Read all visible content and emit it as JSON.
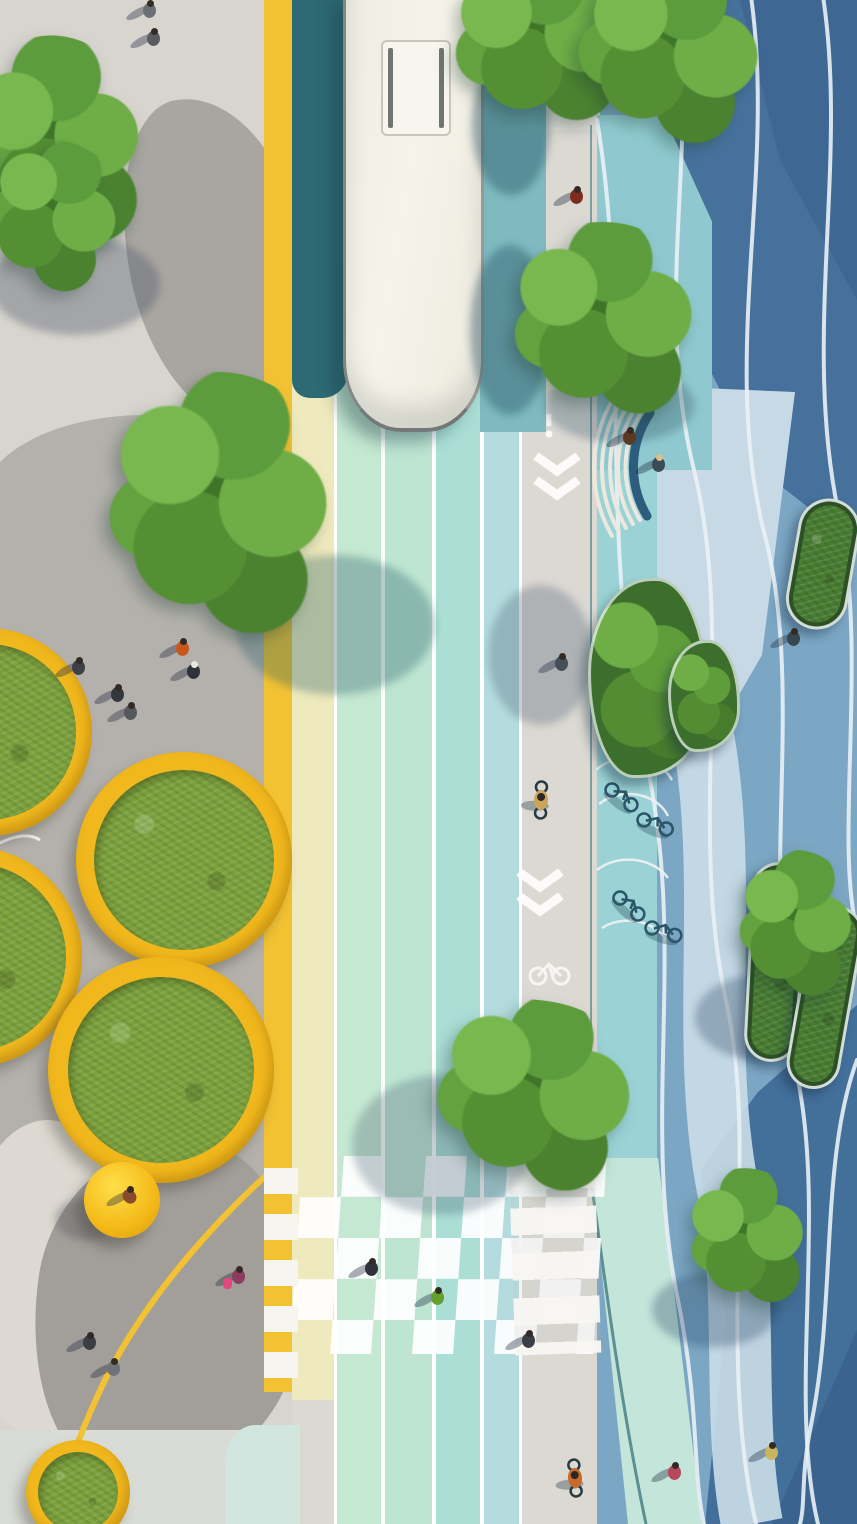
{
  "meta": {
    "kind": "architectural aerial rendering",
    "view": "top-down street redesign visualization",
    "visible_text": "none"
  },
  "palette": {
    "plaza_gray_light": "#d8d5ce",
    "plaza_gray_mid": "#b4b1ac",
    "plaza_gray_dark": "#a29f9a",
    "curb_yellow": "#f2c233",
    "buffer_pale_yellow": "#efeabd",
    "lane_mint_1": "#c5e8d2",
    "lane_mint_2": "#bde5d2",
    "lane_aqua": "#abdfd6",
    "lane_blue": "#b4dcde",
    "lane_shadow_teal": "#2e6a74",
    "lane_sunlit_teal": "#7fbac0",
    "path_gray": "#dcd9d3",
    "marking_white": "#fdfdfb",
    "bikezone_aqua": "#9ad2d6",
    "plaza_blue_base": "#7ba6c4",
    "plaza_blue_dark": "#46719c",
    "plaza_blue_pale": "#c6d9e5",
    "planter_rim_yellow": "#f1b81d",
    "grass_green": "#7ba23c",
    "tree_green": "#5d9c3c",
    "bus_body": "#f3f0e8",
    "bench_back_blue": "#2d5c7c"
  },
  "zones": [
    {
      "name": "pedestrian-plaza-left",
      "surface": "gray concrete with organic paving patches"
    },
    {
      "name": "yellow-curb-stripe",
      "surface": "painted yellow edge line"
    },
    {
      "name": "pale-yellow-buffer",
      "surface": "painted buffer band"
    },
    {
      "name": "transit-lanes",
      "surface": "four mint/aqua colored lanes with white separators"
    },
    {
      "name": "shared-path-gray",
      "surface": "light gray cycle/pedestrian path with chevrons and bike symbol"
    },
    {
      "name": "bike-parking-aqua-strip",
      "surface": "aqua zone with looped bike racks"
    },
    {
      "name": "blue-plaza-right",
      "surface": "blue surface with white flowing wave lines, sun and shadow patches"
    },
    {
      "name": "checkerboard-crossing",
      "surface": "white checker squares over colored lanes"
    },
    {
      "name": "zebra-crossing",
      "surface": "white bars over gray path"
    },
    {
      "name": "yellow-bar-crossing",
      "surface": "white bars over yellow curb band"
    }
  ],
  "scene": {
    "bus": {
      "x": 343,
      "y": -8,
      "w": 141,
      "h": 440,
      "hatch": {
        "x": 378,
        "y": 40,
        "w": 70,
        "h": 96
      }
    },
    "trees": [
      {
        "x": -35,
        "y": 35,
        "w": 185,
        "h": 235,
        "rot": -8
      },
      {
        "x": -25,
        "y": 140,
        "w": 150,
        "h": 160,
        "rot": 14
      },
      {
        "x": 92,
        "y": 372,
        "w": 250,
        "h": 285,
        "rot": 3
      },
      {
        "x": 438,
        "y": -45,
        "w": 205,
        "h": 180,
        "rot": -5
      },
      {
        "x": 560,
        "y": -35,
        "w": 215,
        "h": 185,
        "rot": 9
      },
      {
        "x": 498,
        "y": 222,
        "w": 210,
        "h": 210,
        "rot": -3
      },
      {
        "x": 418,
        "y": 1000,
        "w": 230,
        "h": 200,
        "rot": 6
      },
      {
        "x": 682,
        "y": 1168,
        "w": 130,
        "h": 150,
        "rot": -6
      },
      {
        "x": 732,
        "y": 850,
        "w": 125,
        "h": 160,
        "rot": 4
      }
    ],
    "tree_shadows": [
      {
        "x": -10,
        "y": 235,
        "w": 170,
        "h": 100,
        "c": "rgba(80,88,105,0.38)"
      },
      {
        "x": 235,
        "y": 555,
        "w": 200,
        "h": 140,
        "c": "rgba(35,90,100,0.32)"
      },
      {
        "x": 472,
        "y": 55,
        "w": 78,
        "h": 140,
        "c": "rgba(35,80,95,0.42)"
      },
      {
        "x": 470,
        "y": 245,
        "w": 80,
        "h": 170,
        "c": "rgba(35,80,95,0.40)"
      },
      {
        "x": 488,
        "y": 585,
        "w": 105,
        "h": 140,
        "c": "rgba(70,90,108,0.30)"
      },
      {
        "x": 352,
        "y": 1075,
        "w": 180,
        "h": 140,
        "c": "rgba(70,92,112,0.30)"
      },
      {
        "x": 545,
        "y": 368,
        "w": 150,
        "h": 75,
        "c": "rgba(45,80,100,0.30)"
      },
      {
        "x": 652,
        "y": 1272,
        "w": 125,
        "h": 75,
        "c": "rgba(30,60,92,0.30)"
      },
      {
        "x": 695,
        "y": 975,
        "w": 130,
        "h": 85,
        "c": "rgba(28,58,90,0.30)"
      },
      {
        "x": 55,
        "y": 1198,
        "w": 60,
        "h": 42,
        "c": "rgba(95,95,100,0.40)"
      }
    ],
    "planters_circular": [
      {
        "cx": -12,
        "cy": 732,
        "r": 104,
        "rim": 16
      },
      {
        "cx": 184,
        "cy": 860,
        "r": 108,
        "rim": 18
      },
      {
        "cx": -28,
        "cy": 957,
        "r": 110,
        "rim": 16
      },
      {
        "cx": 161,
        "cy": 1070,
        "r": 113,
        "rim": 20
      },
      {
        "cx": 78,
        "cy": 1492,
        "r": 52,
        "rim": 12
      }
    ],
    "planters_pill": [
      {
        "x": 792,
        "y": 498,
        "w": 62,
        "h": 132,
        "rot": 10
      },
      {
        "x": 748,
        "y": 862,
        "w": 54,
        "h": 200,
        "rot": 3
      },
      {
        "x": 798,
        "y": 905,
        "w": 54,
        "h": 185,
        "rot": 10
      }
    ],
    "shrub_planters": [
      {
        "x": 588,
        "y": 578,
        "w": 120,
        "h": 200
      },
      {
        "x": 668,
        "y": 640,
        "w": 72,
        "h": 112
      }
    ],
    "dome_seat": {
      "cx": 122,
      "cy": 1200,
      "r": 38
    },
    "people": [
      {
        "x": 148,
        "y": 10,
        "c": "#6b6f73"
      },
      {
        "x": 152,
        "y": 38,
        "c": "#585c60"
      },
      {
        "x": 575,
        "y": 196,
        "c": "#7c2d1d"
      },
      {
        "x": 181,
        "y": 648,
        "c": "#c7571f"
      },
      {
        "x": 192,
        "y": 671,
        "c": "#2f3238",
        "hat": "#e8e6e0"
      },
      {
        "x": 77,
        "y": 667,
        "c": "#3c3f44"
      },
      {
        "x": 116,
        "y": 694,
        "c": "#34373c"
      },
      {
        "x": 129,
        "y": 712,
        "c": "#56585c"
      },
      {
        "x": 628,
        "y": 437,
        "c": "#5b3a24"
      },
      {
        "x": 657,
        "y": 464,
        "c": "#3b4b55",
        "hat": "#d9c08a"
      },
      {
        "x": 792,
        "y": 638,
        "c": "#37474f"
      },
      {
        "x": 560,
        "y": 663,
        "c": "#444f58"
      },
      {
        "x": 370,
        "y": 1268,
        "c": "#2f343a"
      },
      {
        "x": 436,
        "y": 1297,
        "c": "#63a02e"
      },
      {
        "x": 527,
        "y": 1340,
        "c": "#3a3e45"
      },
      {
        "x": 128,
        "y": 1196,
        "c": "#8a4a2c",
        "rot": -40
      },
      {
        "x": 237,
        "y": 1276,
        "c": "#8c3b5e",
        "bag": "#e2477f"
      },
      {
        "x": 88,
        "y": 1342,
        "c": "#3b3e42"
      },
      {
        "x": 112,
        "y": 1368,
        "c": "#70747a"
      },
      {
        "x": 673,
        "y": 1472,
        "c": "#b5485a"
      },
      {
        "x": 770,
        "y": 1452,
        "c": "#c9b45f"
      }
    ],
    "cyclists": [
      {
        "x": 541,
        "y": 800,
        "c": "#caa45a",
        "rot": 182
      },
      {
        "x": 575,
        "y": 1478,
        "c": "#c96a2d",
        "rot": 175
      }
    ],
    "parked_bikes": [
      {
        "x": 612,
        "y": 790,
        "rot": 38
      },
      {
        "x": 644,
        "y": 820,
        "rot": 22
      },
      {
        "x": 620,
        "y": 898,
        "rot": 42
      },
      {
        "x": 652,
        "y": 928,
        "rot": 18
      }
    ],
    "rack_arcs": [
      "M596,770 A46,38 0 0 1 672,780",
      "M599,804 A42,34 0 0 1 668,816",
      "M597,870 A46,38 0 0 1 668,878",
      "M602,928 A42,34 0 0 1 666,940"
    ],
    "pale_ribbon": "M700,720 C733,880 696,1040 730,1200 C748,1300 732,1420 752,1524",
    "wavy_lines": [
      "M676,-10 C700,140 652,300 694,470 C736,640 686,830 728,1010 C758,1160 716,1350 756,1524",
      "M750,-10 C778,170 718,360 766,540 C806,700 756,900 798,1080 C826,1220 788,1400 818,1524",
      "M822,-10 C850,160 800,340 840,520 C868,660 834,840 857,930",
      "M597,120 C632,330 596,540 646,760 C688,950 640,1120 678,1300 C700,1410 692,1470 704,1524",
      "M857,1060 C820,1160 836,1300 812,1420 C800,1478 806,1500 800,1524"
    ],
    "chevrons": [
      {
        "x": 557,
        "y": 456
      },
      {
        "x": 540,
        "y": 872
      }
    ],
    "exclaim_mark": {
      "x": 549,
      "y": 414
    },
    "bike_symbol": {
      "x": 549,
      "y": 970
    },
    "bench": {
      "back": "M647,516 A96,96 0 0 1 650,413",
      "slats": [
        "M640,520 A104,104 0 0 1 644,408",
        "M633,524 A112,112 0 0 1 638,404",
        "M626,528 A120,120 0 0 1 632,399",
        "M619,532 A128,128 0 0 1 625,395",
        "M612,536 A136,136 0 0 1 619,390"
      ]
    },
    "yellow_edge_path": "M288,1156 C225,1210 150,1290 105,1380 C80,1432 62,1480 56,1524",
    "white_plaza_curve": "M-6,846 C12,836 28,832 40,840",
    "teal_edge_line": "M591,125 L591,1158",
    "band_edge_line": "M588,1158 C606,1290 622,1410 646,1524"
  }
}
